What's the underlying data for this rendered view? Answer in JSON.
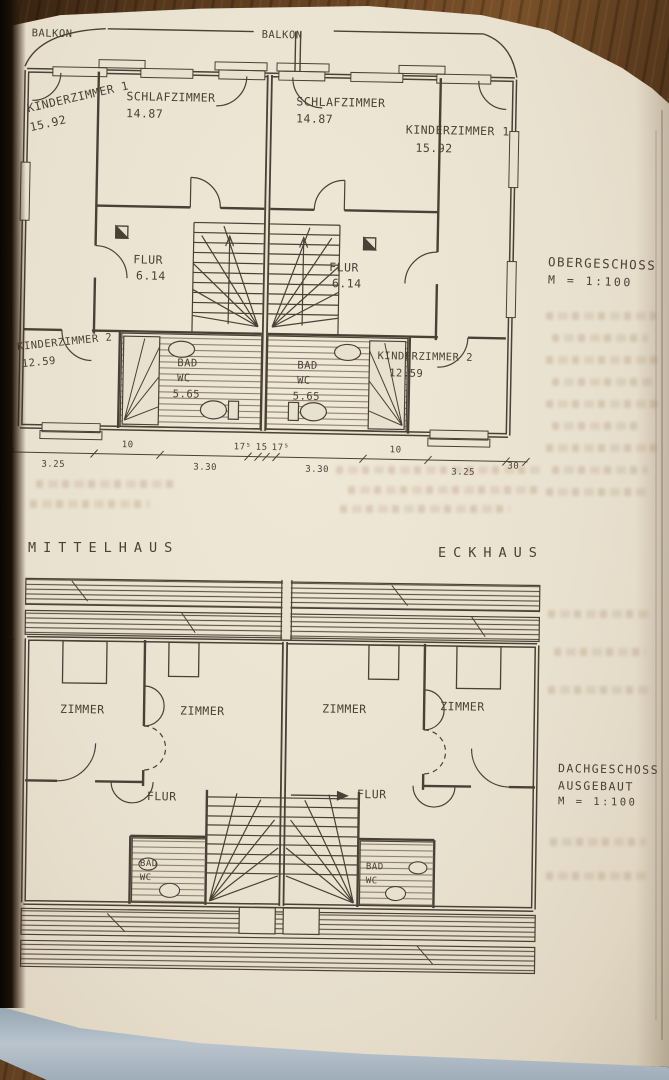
{
  "palette": {
    "wood": "#5e3d20",
    "paper": "#e9e1cf",
    "ink": "#4a4036",
    "page_edge_blue": "#a9b6c1",
    "hatch": "#8b7b68"
  },
  "upper_plan": {
    "title": "OBERGESCHOSS",
    "scale": "M = 1:100",
    "balkon_left": "BALKON",
    "balkon_right": "BALKON",
    "left_unit": {
      "kinderzimmer1_name": "KINDERZIMMER 1",
      "kinderzimmer1_area": "15.92",
      "schlafzimmer_name": "SCHLAFZIMMER",
      "schlafzimmer_area": "14.87",
      "flur_name": "FLUR",
      "flur_area": "6.14",
      "kinderzimmer2_name": "KINDERZIMMER 2",
      "kinderzimmer2_area": "12.59",
      "bad_name": "BAD",
      "wc_name": "WC",
      "bad_area": "5.65"
    },
    "right_unit": {
      "schlafzimmer_name": "SCHLAFZIMMER",
      "schlafzimmer_area": "14.87",
      "kinderzimmer1_name": "KINDERZIMMER 1",
      "kinderzimmer1_area": "15.92",
      "flur_name": "FLUR",
      "flur_area": "6.14",
      "kinderzimmer2_name": "KINDERZIMMER 2",
      "kinderzimmer2_area": "12.59",
      "bad_name": "BAD",
      "wc_name": "WC",
      "bad_area": "5.65"
    },
    "dims": [
      "3.25",
      "10",
      "3.30",
      "17⁵",
      "15",
      "17⁵",
      "3.30",
      "10",
      "3.25",
      "30"
    ],
    "dim_edge_mark": "5"
  },
  "section_labels": {
    "left": "MITTELHAUS",
    "right": "ECKHAUS"
  },
  "lower_plan": {
    "title_line1": "DACHGESCHOSS",
    "title_line2": "AUSGEBAUT",
    "scale": "M = 1:100",
    "left_unit": {
      "zimmer_a": "ZIMMER",
      "zimmer_b": "ZIMMER",
      "flur": "FLUR",
      "bad": "BAD",
      "wc": "WC"
    },
    "right_unit": {
      "zimmer_a": "ZIMMER",
      "zimmer_b": "ZIMMER",
      "flur": "FLUR",
      "bad": "BAD",
      "wc": "WC"
    }
  }
}
